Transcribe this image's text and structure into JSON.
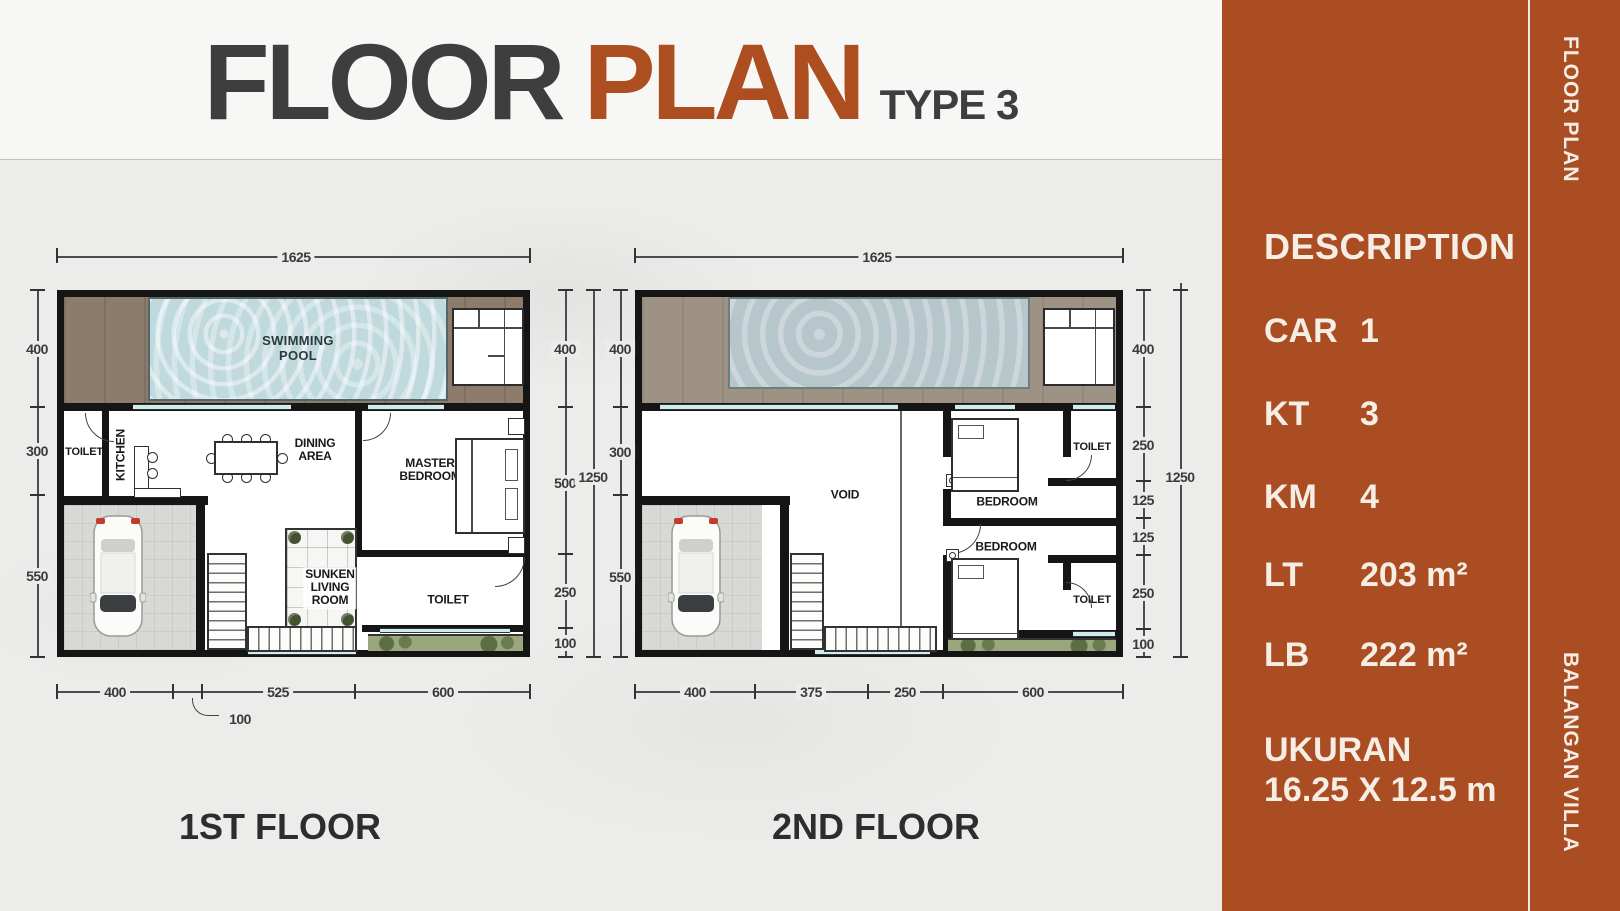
{
  "header": {
    "title_main": "FLOOR",
    "title_accent": "PLAN",
    "title_type": "TYPE 3"
  },
  "colors": {
    "accent": "#AA4D23",
    "title_dark": "#3E3E3E",
    "title_accent": "#AC4E20",
    "pool": "#BFD9DD",
    "deck_wood": "#8D7C6C"
  },
  "plans": {
    "plan1": {
      "caption": "1ST FLOOR",
      "top_dim": "1625",
      "left_dims": [
        "400",
        "300",
        "550"
      ],
      "right_dims": [
        "400",
        "500",
        "250",
        "100"
      ],
      "overall_dim": "1250",
      "bottom_dims": [
        "400",
        "100",
        "525",
        "600"
      ],
      "labels": {
        "pool": [
          "SWIMMING",
          "POOL"
        ],
        "toilet_top": "TOILET",
        "kitchen": "KITCHEN",
        "dining": [
          "DINING",
          "AREA"
        ],
        "master": [
          "MASTER",
          "BEDROOM"
        ],
        "sunken": [
          "SUNKEN",
          "LIVING",
          "ROOM"
        ],
        "toilet_bottom": "TOILET"
      }
    },
    "plan2": {
      "caption": "2ND FLOOR",
      "top_dim": "1625",
      "left_dims": [
        "400",
        "300",
        "550"
      ],
      "right_dims": [
        "400",
        "250",
        "125",
        "125",
        "250",
        "100"
      ],
      "overall_dim": "1250",
      "bottom_dims": [
        "400",
        "375",
        "250",
        "600"
      ],
      "labels": {
        "void": "VOID",
        "bedroom_top": "BEDROOM",
        "bedroom_bottom": "BEDROOM",
        "toilet_top": "TOILET",
        "toilet_bottom": "TOILET"
      }
    }
  },
  "sidebar": {
    "heading": "DESCRIPTION",
    "rows": [
      {
        "label": "CAR",
        "value": "1"
      },
      {
        "label": "KT",
        "value": "3"
      },
      {
        "label": "KM",
        "value": "4"
      },
      {
        "label": "LT",
        "value": "203 m²"
      },
      {
        "label": "LB",
        "value": "222 m²"
      }
    ],
    "size_label": "UKURAN",
    "size_value": "16.25 X 12.5 m",
    "vertical_top": "FLOOR PLAN",
    "vertical_bottom": "BALANGAN VILLA"
  }
}
